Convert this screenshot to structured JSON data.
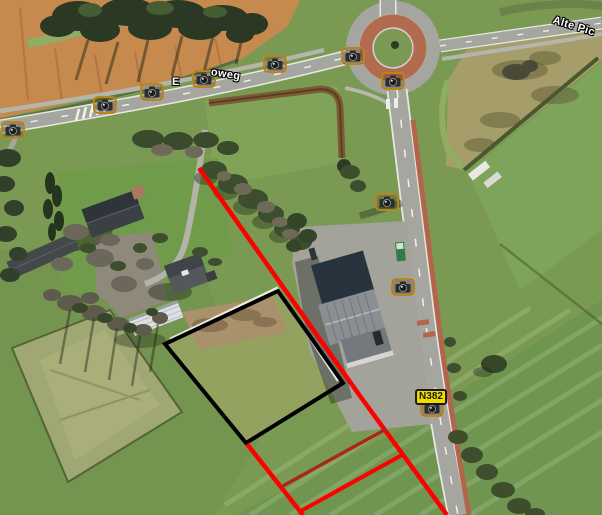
{
  "view": {
    "kind": "aerial-photo-map",
    "width": 602,
    "height": 515
  },
  "overlays": {
    "road_badge": {
      "label": "N382",
      "bg_color": "#f2dc00",
      "border_color": "#1a1a1a",
      "text_color": "#1a1a1a",
      "x": 431,
      "y": 397
    },
    "street_labels": [
      {
        "text": "E",
        "x": 172,
        "y": 76,
        "angle": 0
      },
      {
        "text": "oweg",
        "x": 211,
        "y": 66,
        "angle": 9
      },
      {
        "text": "Alte Pic",
        "x": 553,
        "y": 14,
        "angle": 17
      }
    ],
    "camera_markers": {
      "icon": "camera-icon",
      "border_color": "#d89a20",
      "positions": [
        {
          "x": 13,
          "y": 130
        },
        {
          "x": 105,
          "y": 105
        },
        {
          "x": 152,
          "y": 92
        },
        {
          "x": 204,
          "y": 79
        },
        {
          "x": 275,
          "y": 64
        },
        {
          "x": 353,
          "y": 56
        },
        {
          "x": 393,
          "y": 81
        },
        {
          "x": 387,
          "y": 202
        },
        {
          "x": 403,
          "y": 287
        },
        {
          "x": 432,
          "y": 408
        }
      ]
    },
    "annotations": {
      "parcel_outline": {
        "color": "#000000",
        "points": "278,291 165,344 246,443 343,383"
      },
      "red_lines": {
        "color": "#ff0000",
        "dark_color": "#a62a1c",
        "main_diagonal": "199,168 360,396 447,515",
        "parallel_line": "247,444 303,515",
        "cross_line_1": "386,429 281,487",
        "cross_line_2": "402,455 299,512"
      }
    }
  }
}
